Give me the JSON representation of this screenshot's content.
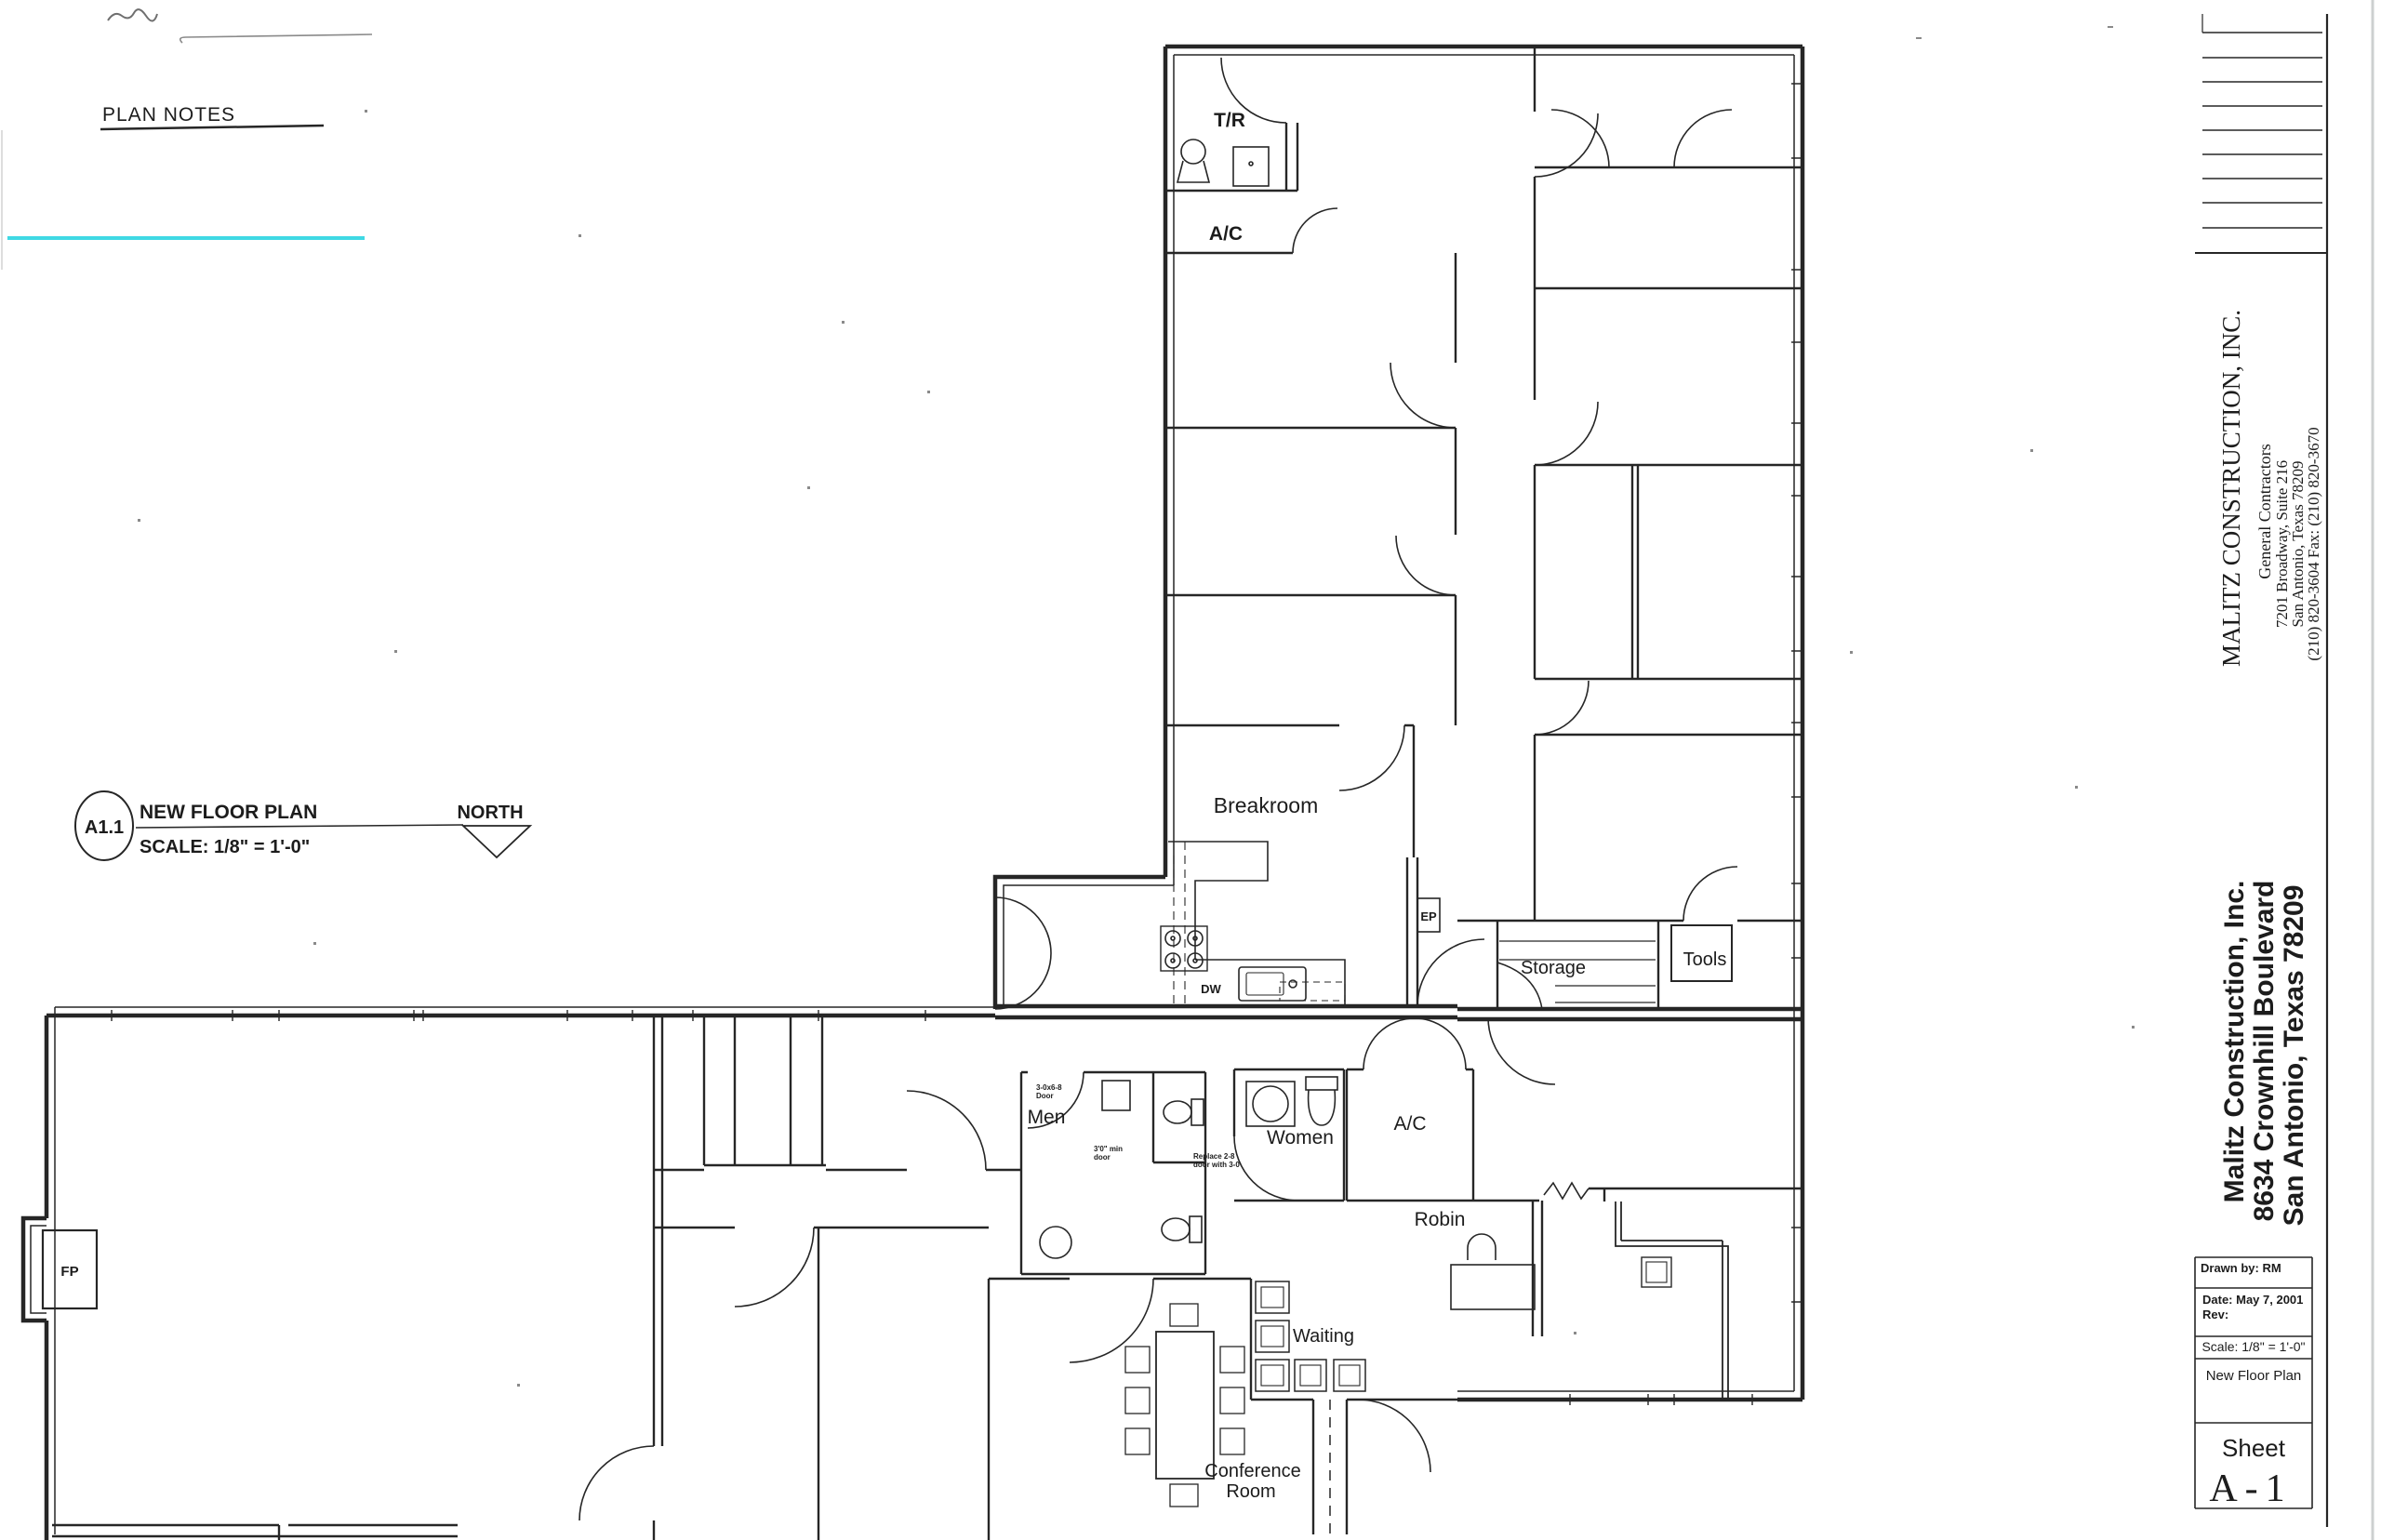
{
  "sheet": {
    "plan_notes_title": "PLAN NOTES",
    "callout_ref": "A1.1",
    "callout_title": "NEW FLOOR PLAN",
    "callout_scale": "SCALE: 1/8\" = 1'-0\"",
    "north_label": "NORTH"
  },
  "rooms": {
    "tr": "T/R",
    "ac_upper": "A/C",
    "breakroom": "Breakroom",
    "ep": "EP",
    "dw": "DW",
    "storage": "Storage",
    "tools": "Tools",
    "men": "Men",
    "women": "Women",
    "ac_lower": "A/C",
    "robin": "Robin",
    "waiting": "Waiting",
    "conference_line1": "Conference",
    "conference_line2": "Room",
    "fp": "FP"
  },
  "annotations": {
    "men_door_size": "3-0x6-8",
    "men_door_word": "Door",
    "men_clear_1": "3'0\" min",
    "men_clear_2": "door",
    "women_note_1": "Replace 2-8",
    "women_note_2": "door with 3-0"
  },
  "titleblock": {
    "company_name": "MALITZ CONSTRUCTION, INC.",
    "company_subtitle": "General Contractors",
    "company_address1": "7201 Broadway, Suite 216",
    "company_address2": "San Antonio, Texas 78209",
    "company_phone": "(210) 820-3604 Fax: (210) 820-3670",
    "project_line1": "Malitz Construction, Inc.",
    "project_line2": "8634 Crownhill Boulevard",
    "project_line3": "San Antonio, Texas 78209",
    "drawn_by": "Drawn by: RM",
    "date": "Date: May 7, 2001",
    "rev": "Rev:",
    "scale": "Scale: 1/8\" = 1'-0\"",
    "sheet_title": "New Floor Plan",
    "sheet_word": "Sheet",
    "sheet_number": "A-1"
  },
  "colors": {
    "highlight_cyan": "#3fd9e4",
    "ink": "#262626"
  }
}
